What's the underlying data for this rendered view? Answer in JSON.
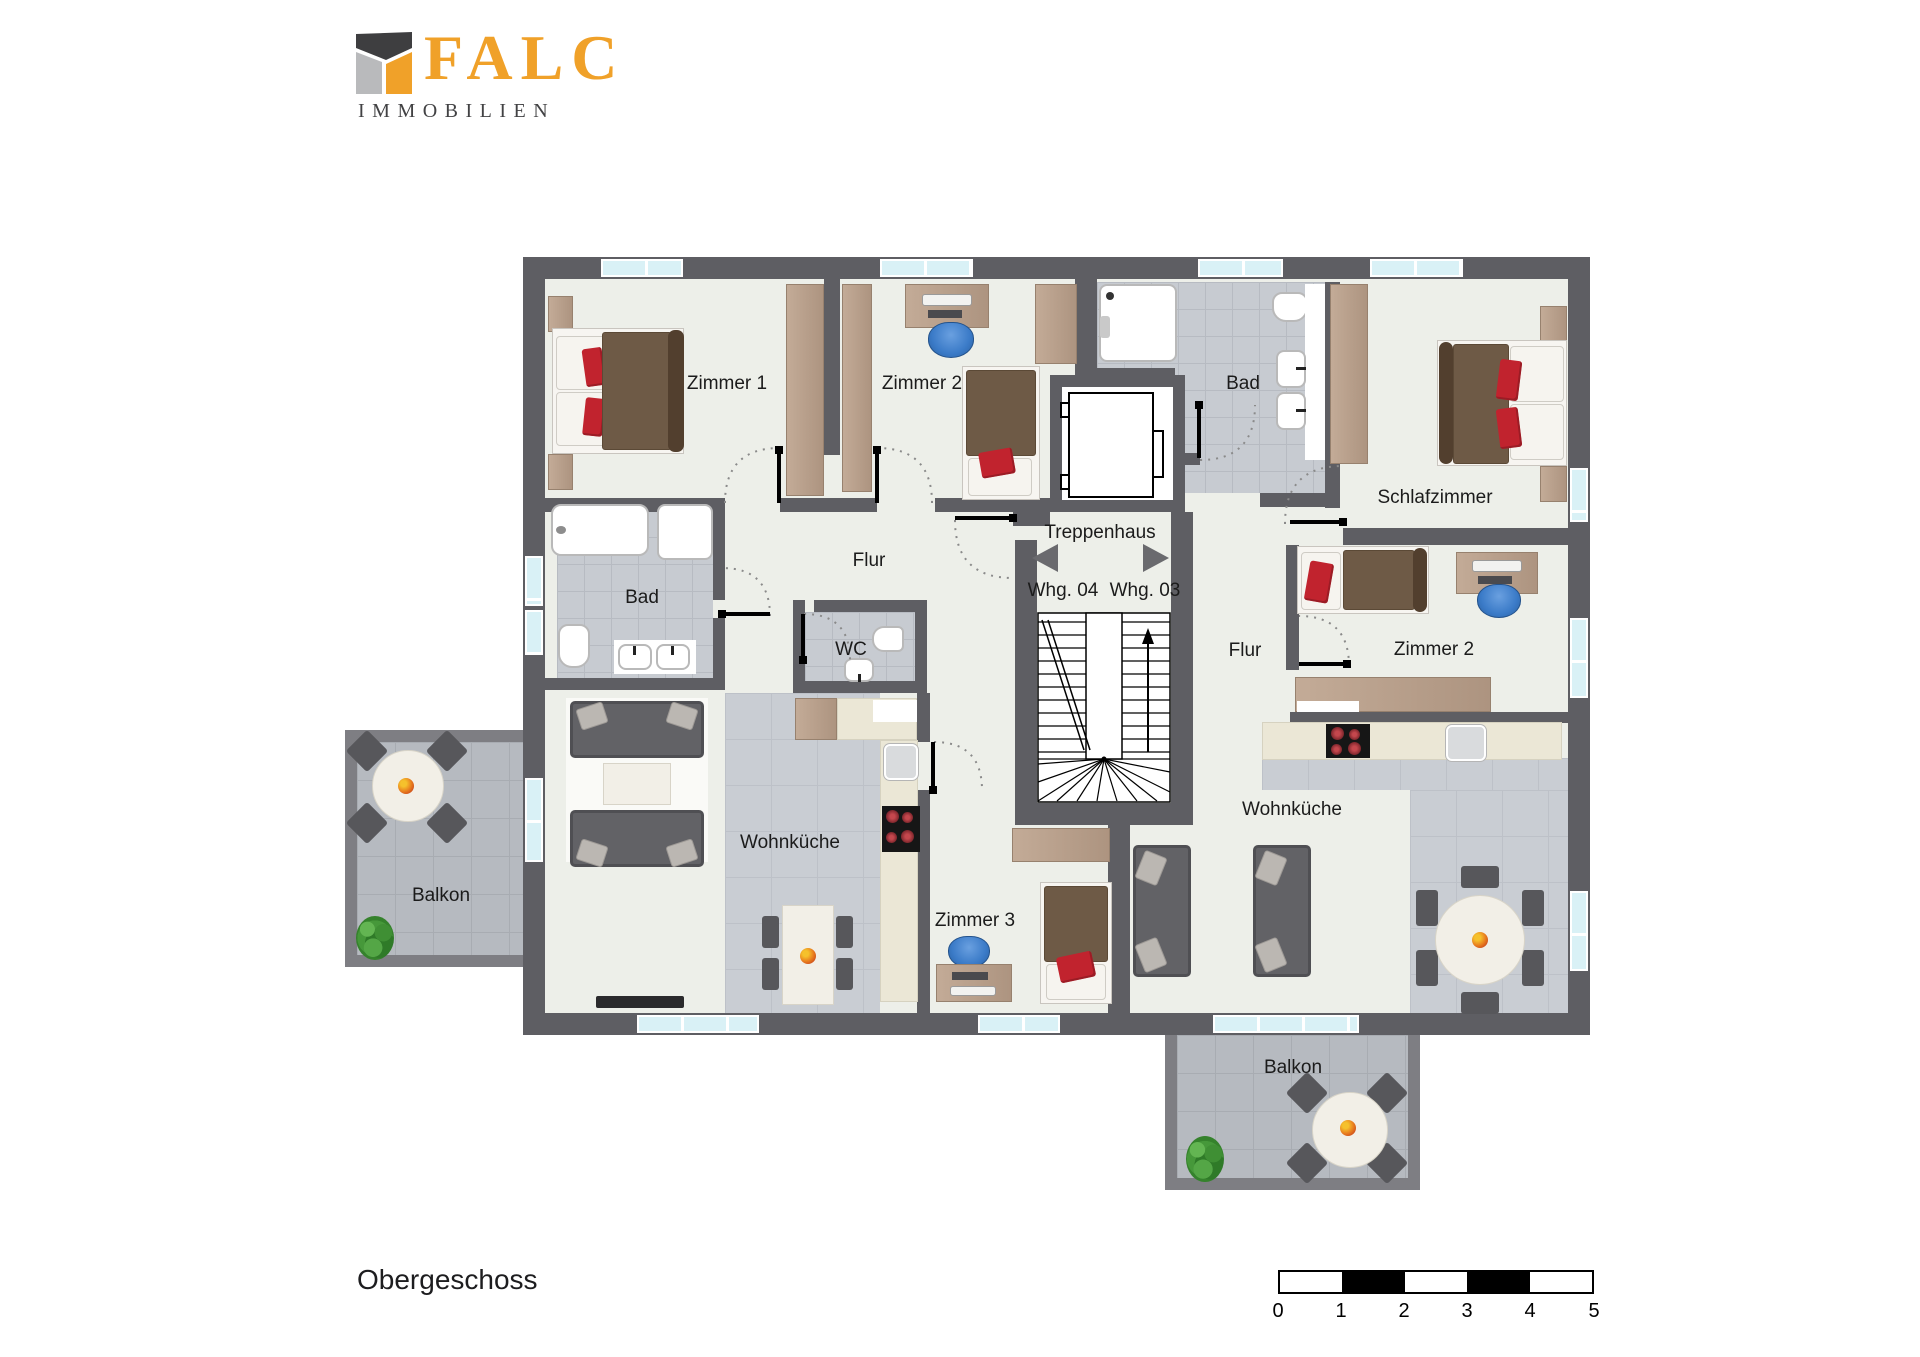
{
  "brand": {
    "name": "FALC",
    "subtitle": "IMMOBILIEN"
  },
  "floor": {
    "title": "Obergeschoss"
  },
  "scale_bar": {
    "ticks": [
      "0",
      "1",
      "2",
      "3",
      "4",
      "5"
    ]
  },
  "rooms": [
    {
      "id": "zimmer1",
      "label": "Zimmer 1"
    },
    {
      "id": "zimmer2-left",
      "label": "Zimmer 2"
    },
    {
      "id": "bad-right",
      "label": "Bad"
    },
    {
      "id": "schlafzimmer",
      "label": "Schlafzimmer"
    },
    {
      "id": "treppenhaus",
      "label": "Treppenhaus"
    },
    {
      "id": "whg-04",
      "label": "Whg. 04"
    },
    {
      "id": "whg-03",
      "label": "Whg. 03"
    },
    {
      "id": "flur-left",
      "label": "Flur"
    },
    {
      "id": "bad-left",
      "label": "Bad"
    },
    {
      "id": "wc",
      "label": "WC"
    },
    {
      "id": "flur-right",
      "label": "Flur"
    },
    {
      "id": "zimmer2-right",
      "label": "Zimmer 2"
    },
    {
      "id": "wohnkueche-left",
      "label": "Wohnküche"
    },
    {
      "id": "zimmer3",
      "label": "Zimmer 3"
    },
    {
      "id": "wohnkueche-right",
      "label": "Wohnküche"
    },
    {
      "id": "balkon-left",
      "label": "Balkon"
    },
    {
      "id": "balkon-bottom",
      "label": "Balkon"
    }
  ],
  "colors": {
    "wall": "#5e5e63",
    "brand_orange": "#f0a129",
    "window": "#d9f1f6",
    "bed_brown": "#6e5a46",
    "accent_red": "#c1232e",
    "office_chair_blue": "#3b7bc8",
    "wood": "#b59c87",
    "sofa_gray": "#646468",
    "bath_tile": "#c7cbd1"
  }
}
